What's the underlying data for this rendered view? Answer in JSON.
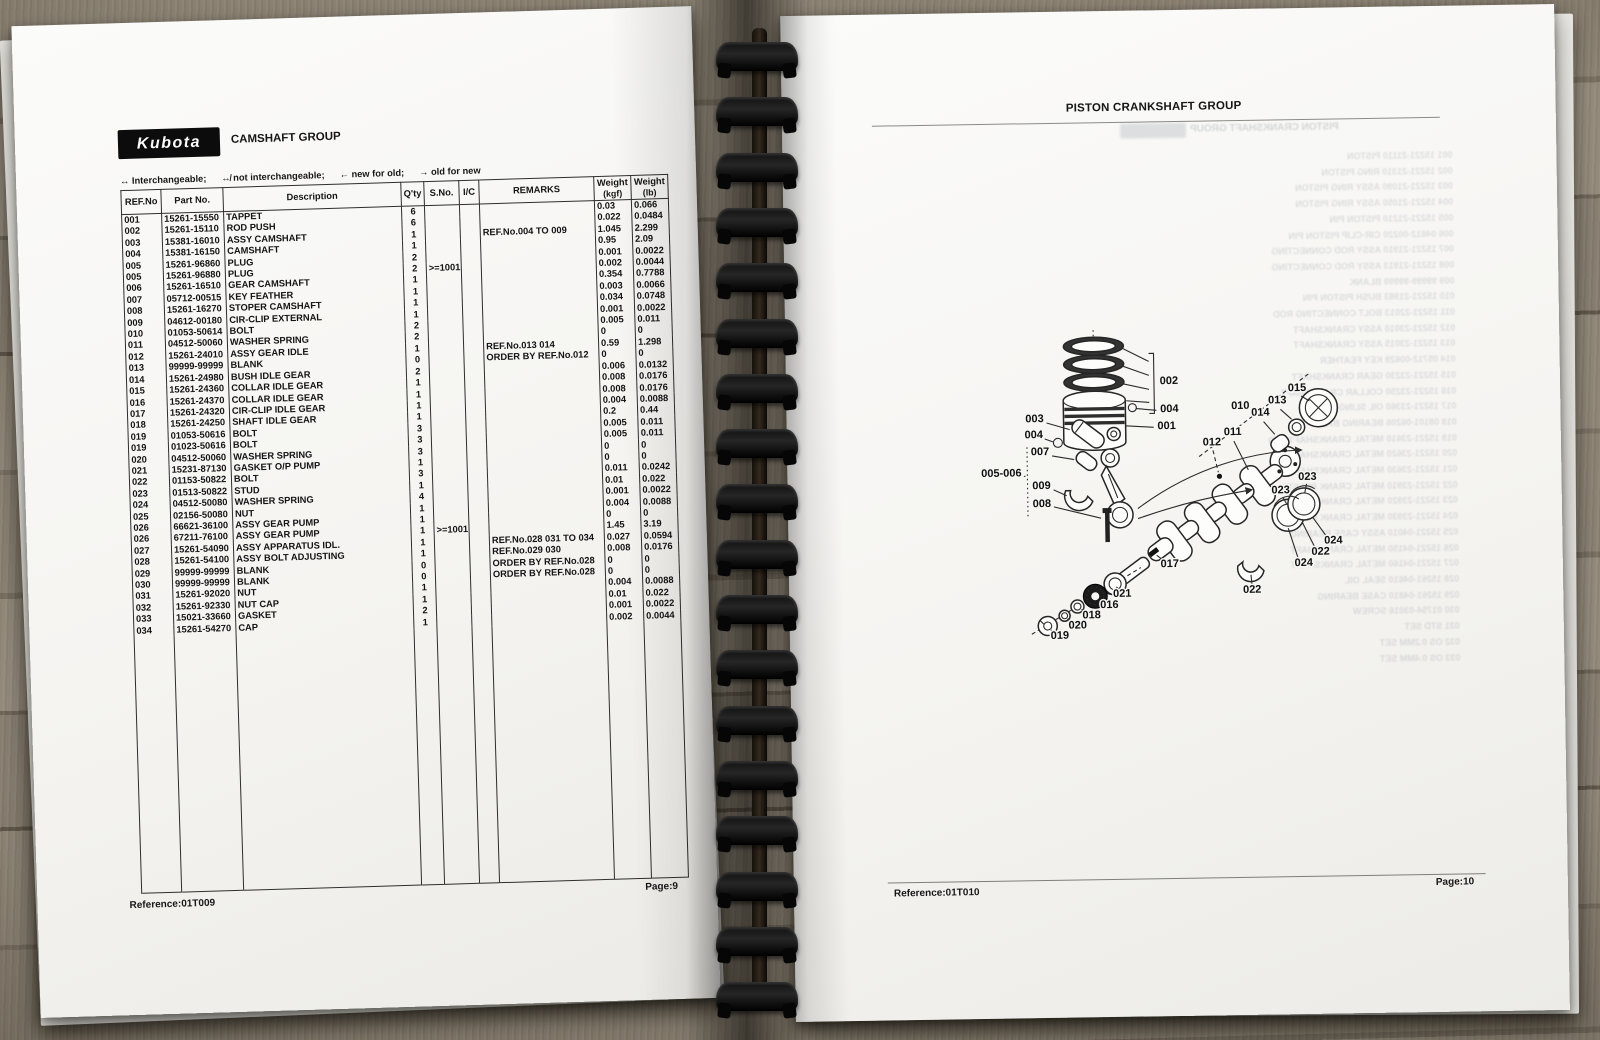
{
  "colors": {
    "page": "#f8f8f5",
    "ink": "#161616",
    "binding": "#0c0c0c",
    "wood": "#837a6c",
    "logo_bg": "#0c0c0c"
  },
  "binding": {
    "loop_count": 18
  },
  "left_page": {
    "logo_text": "Kubota",
    "title": "CAMSHAFT GROUP",
    "legend": [
      {
        "sym": "↔",
        "label": "Interchangeable;"
      },
      {
        "sym": "↮",
        "label": "not interchangeable;"
      },
      {
        "sym": "←",
        "label": "new for old;"
      },
      {
        "sym": "→",
        "label": "old for new"
      }
    ],
    "table": {
      "headers": {
        "ref": "REF.No",
        "part": "Part No.",
        "desc": "Description",
        "qty": "Q'ty",
        "sno": "S.No.",
        "ic": "I/C",
        "remarks": "REMARKS",
        "w1a": "Weight",
        "w1b": "(kgf)",
        "w2a": "Weight",
        "w2b": "(lb)"
      },
      "rows": [
        [
          "001",
          "15261-15550",
          "TAPPET",
          "6",
          "",
          "",
          "",
          "0.03",
          "0.066"
        ],
        [
          "002",
          "15261-15110",
          "ROD PUSH",
          "6",
          "",
          "",
          "",
          "0.022",
          "0.0484"
        ],
        [
          "003",
          "15381-16010",
          "ASSY CAMSHAFT",
          "1",
          "",
          "",
          "REF.No.004 TO 009",
          "1.045",
          "2.299"
        ],
        [
          "004",
          "15381-16150",
          "CAMSHAFT",
          "1",
          "",
          "",
          "",
          "0.95",
          "2.09"
        ],
        [
          "005",
          "15261-96860",
          "PLUG",
          "2",
          "",
          "",
          "",
          "0.001",
          "0.0022"
        ],
        [
          "005",
          "15261-96880",
          "PLUG",
          "2",
          ">=1001",
          "",
          "",
          "0.002",
          "0.0044"
        ],
        [
          "006",
          "15261-16510",
          "GEAR CAMSHAFT",
          "1",
          "",
          "",
          "",
          "0.354",
          "0.7788"
        ],
        [
          "007",
          "05712-00515",
          "KEY FEATHER",
          "1",
          "",
          "",
          "",
          "0.003",
          "0.0066"
        ],
        [
          "008",
          "15261-16270",
          "STOPER CAMSHAFT",
          "1",
          "",
          "",
          "",
          "0.034",
          "0.0748"
        ],
        [
          "009",
          "04612-00180",
          "CIR-CLIP EXTERNAL",
          "1",
          "",
          "",
          "",
          "0.001",
          "0.0022"
        ],
        [
          "010",
          "01053-50614",
          "BOLT",
          "2",
          "",
          "",
          "",
          "0.005",
          "0.011"
        ],
        [
          "011",
          "04512-50060",
          "WASHER SPRING",
          "2",
          "",
          "",
          "",
          "0",
          "0"
        ],
        [
          "012",
          "15261-24010",
          "ASSY GEAR IDLE",
          "1",
          "",
          "",
          "REF.No.013 014",
          "0.59",
          "1.298"
        ],
        [
          "013",
          "99999-99999",
          "BLANK",
          "0",
          "",
          "",
          "ORDER BY REF.No.012",
          "0",
          "0"
        ],
        [
          "014",
          "15261-24980",
          "BUSH IDLE GEAR",
          "2",
          "",
          "",
          "",
          "0.006",
          "0.0132"
        ],
        [
          "015",
          "15261-24360",
          "COLLAR IDLE GEAR",
          "1",
          "",
          "",
          "",
          "0.008",
          "0.0176"
        ],
        [
          "016",
          "15261-24370",
          "COLLAR IDLE GEAR",
          "1",
          "",
          "",
          "",
          "0.008",
          "0.0176"
        ],
        [
          "017",
          "15261-24320",
          "CIR-CLIP IDLE GEAR",
          "1",
          "",
          "",
          "",
          "0.004",
          "0.0088"
        ],
        [
          "018",
          "15261-24250",
          "SHAFT IDLE GEAR",
          "1",
          "",
          "",
          "",
          "0.2",
          "0.44"
        ],
        [
          "019",
          "01053-50616",
          "BOLT",
          "3",
          "",
          "",
          "",
          "0.005",
          "0.011"
        ],
        [
          "019",
          "01023-50616",
          "BOLT",
          "3",
          "",
          "",
          "",
          "0.005",
          "0.011"
        ],
        [
          "020",
          "04512-50060",
          "WASHER SPRING",
          "3",
          "",
          "",
          "",
          "0",
          "0"
        ],
        [
          "021",
          "15231-87130",
          "GASKET O/P PUMP",
          "1",
          "",
          "",
          "",
          "0",
          "0"
        ],
        [
          "022",
          "01153-50822",
          "BOLT",
          "3",
          "",
          "",
          "",
          "0.011",
          "0.0242"
        ],
        [
          "023",
          "01513-50822",
          "STUD",
          "1",
          "",
          "",
          "",
          "0.01",
          "0.022"
        ],
        [
          "024",
          "04512-50080",
          "WASHER SPRING",
          "4",
          "",
          "",
          "",
          "0.001",
          "0.0022"
        ],
        [
          "025",
          "02156-50080",
          "NUT",
          "1",
          "",
          "",
          "",
          "0.004",
          "0.0088"
        ],
        [
          "026",
          "66621-36100",
          "ASSY GEAR PUMP",
          "1",
          "",
          "",
          "",
          "0",
          "0"
        ],
        [
          "026",
          "67211-76100",
          "ASSY GEAR PUMP",
          "1",
          ">=1001",
          "",
          "",
          "1.45",
          "3.19"
        ],
        [
          "027",
          "15261-54090",
          "ASSY APPARATUS IDL.",
          "1",
          "",
          "",
          "REF.No.028 031 TO 034",
          "0.027",
          "0.0594"
        ],
        [
          "028",
          "15261-54100",
          "ASSY BOLT ADJUSTING",
          "1",
          "",
          "",
          "REF.No.029 030",
          "0.008",
          "0.0176"
        ],
        [
          "029",
          "99999-99999",
          "BLANK",
          "0",
          "",
          "",
          "ORDER BY REF.No.028",
          "0",
          "0"
        ],
        [
          "030",
          "99999-99999",
          "BLANK",
          "0",
          "",
          "",
          "ORDER BY REF.No.028",
          "0",
          "0"
        ],
        [
          "031",
          "15261-92020",
          "NUT",
          "1",
          "",
          "",
          "",
          "0.004",
          "0.0088"
        ],
        [
          "032",
          "15261-92330",
          "NUT CAP",
          "1",
          "",
          "",
          "",
          "0.01",
          "0.022"
        ],
        [
          "033",
          "15021-33660",
          "GASKET",
          "2",
          "",
          "",
          "",
          "0.001",
          "0.0022"
        ],
        [
          "034",
          "15261-54270",
          "CAP",
          "1",
          "",
          "",
          "",
          "0.002",
          "0.0044"
        ]
      ]
    },
    "footer": {
      "reference": "Reference:01T009",
      "page": "Page:9"
    }
  },
  "right_page": {
    "title": "PISTON CRANKSHAFT GROUP",
    "footer": {
      "reference": "Reference:01T010",
      "page": "Page:10"
    },
    "ghost": {
      "title": "PISTON CRANKSHAFT GROUP",
      "lines": [
        "001   15221-21110   PISTON",
        "002   15221-21310   RING PISTON",
        "003   15221-21090   ASSY RING PISTON",
        "004   15221-21050   ASSY RING PISTON",
        "005   15221-21210   PISTON PIN",
        "006   04612-00220   CIR-CLIP PISTON PIN",
        "007   15221-21910   ASSY ROD CONNECTING",
        "008   15221-21913   ASSY ROD CONNECTING",
        "009   99999-99999   BLANK",
        "010   15221-21983   BUSH PISTON PIN",
        "011   15221-22013   BOLT CONNECTING ROD",
        "012   15221-23010   ASSY CRANKSHAFT",
        "013   15221-23015   ASSY CRANKSHAFT",
        "014   05712-00628   KEY FEATHER",
        "015   15221-23230   GEAR CRANKSHAFT",
        "016   15221-23250   COLLAR CRANKSHAFT",
        "017   15221-23360   OIL SLINGER",
        "018   08101-06206   BEARING BALL",
        "019   15221-23610   METAL CRANKSHAFT STD",
        "020   15221-23620   METAL CRANKSHAFT 0.2",
        "021   15221-23630   METAL CRANKSHAFT 0.4",
        "022   15221-23910   METAL CRANK PIN STD",
        "023   15221-23920   METAL CRANK PIN 0.2",
        "024   15221-23930   METAL CRANK PIN 0.4",
        "025   15221-04010   ASSY CASE BEARING",
        "026   15221-04150   METAL CRANKSHAFT",
        "027   15221-04160   METAL CRANKSHAFT",
        "028   15261-04610   SEAL OIL",
        "029   15261-04810   CASE BEARING",
        "030   01754-03016   SCREW",
        "031   STD SET",
        "032   OS 0.2MM SET",
        "033   OS 0.4MM SET"
      ]
    },
    "diagram": {
      "callouts": [
        {
          "t": "002",
          "x": 203,
          "y": 79
        },
        {
          "t": "004",
          "x": 203,
          "y": 107
        },
        {
          "t": "001",
          "x": 200,
          "y": 124
        },
        {
          "t": "003",
          "x": 68,
          "y": 115
        },
        {
          "t": "004",
          "x": 67,
          "y": 131
        },
        {
          "t": "007",
          "x": 73,
          "y": 148
        },
        {
          "t": "005-006",
          "x": 34,
          "y": 169
        },
        {
          "t": "009",
          "x": 74,
          "y": 182
        },
        {
          "t": "008",
          "x": 74,
          "y": 200
        },
        {
          "t": "010",
          "x": 274,
          "y": 105
        },
        {
          "t": "011",
          "x": 266,
          "y": 131
        },
        {
          "t": "012",
          "x": 245,
          "y": 141
        },
        {
          "t": "013",
          "x": 311,
          "y": 100
        },
        {
          "t": "014",
          "x": 294,
          "y": 112
        },
        {
          "t": "015",
          "x": 331,
          "y": 88
        },
        {
          "t": "017",
          "x": 201,
          "y": 262
        },
        {
          "t": "021",
          "x": 153,
          "y": 291
        },
        {
          "t": "016",
          "x": 140,
          "y": 302
        },
        {
          "t": "018",
          "x": 122,
          "y": 312
        },
        {
          "t": "020",
          "x": 108,
          "y": 322
        },
        {
          "t": "019",
          "x": 90,
          "y": 332
        },
        {
          "t": "023",
          "x": 313,
          "y": 190
        },
        {
          "t": "023",
          "x": 340,
          "y": 177
        },
        {
          "t": "024",
          "x": 365,
          "y": 241
        },
        {
          "t": "022",
          "x": 352,
          "y": 252
        },
        {
          "t": "024",
          "x": 335,
          "y": 263
        },
        {
          "t": "022",
          "x": 283,
          "y": 289
        }
      ]
    }
  }
}
